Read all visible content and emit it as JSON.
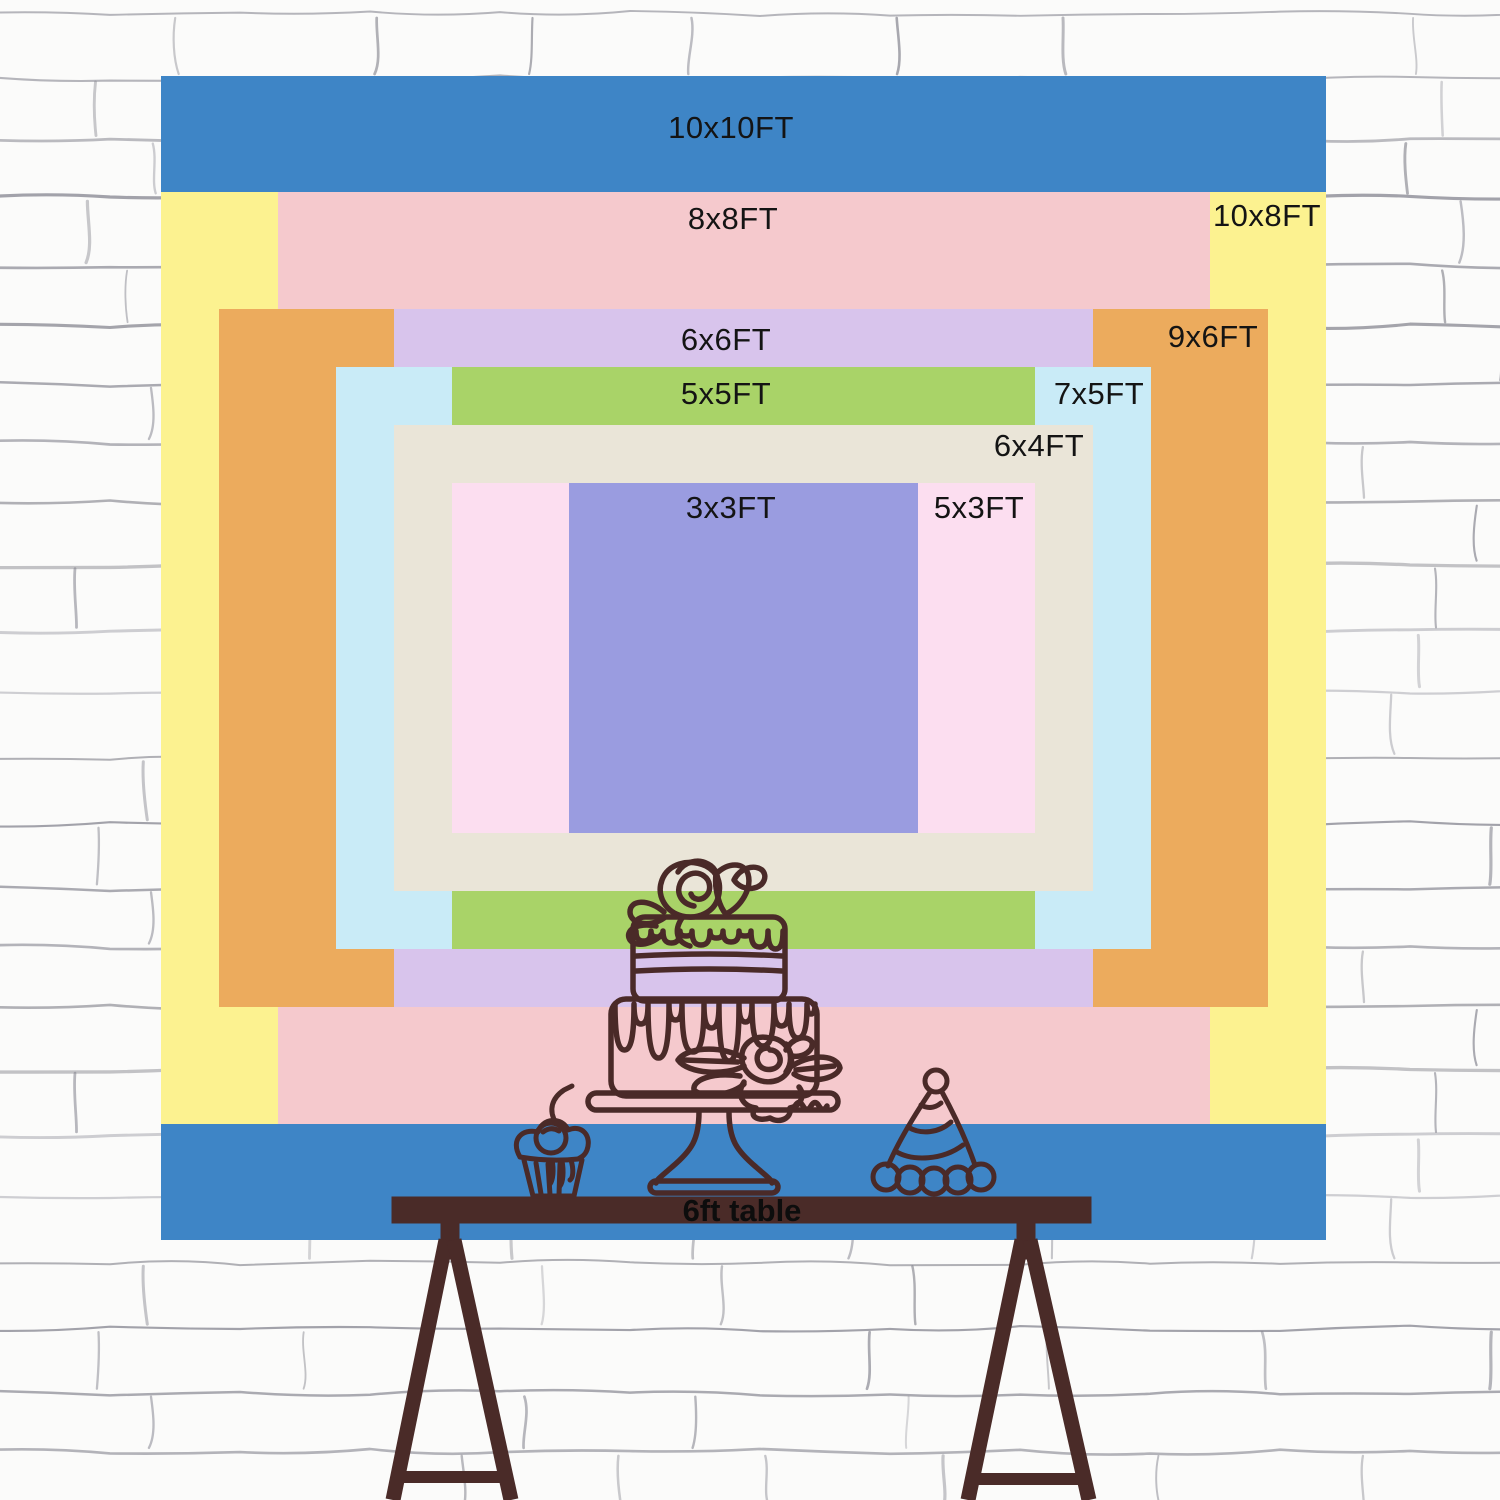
{
  "page": {
    "description_label": "Backdrop size comparison chart on brick wall"
  },
  "chart_data": {
    "type": "nested_rectangles_size_chart",
    "unit": "FT",
    "backdrop": {
      "left": 161,
      "top": 76,
      "width": 1165,
      "height": 1164,
      "feet": 10
    },
    "legend_position": "labels inside bands",
    "sizes": [
      {
        "label": "10x10FT",
        "w_ft": 10,
        "h_ft": 10,
        "color": "#3E85C6",
        "label_x": 731,
        "label_y": 128
      },
      {
        "label": "10x8FT",
        "w_ft": 10,
        "h_ft": 8,
        "color": "#FCF290",
        "label_x": 1267,
        "label_y": 216
      },
      {
        "label": "8x8FT",
        "w_ft": 8,
        "h_ft": 8,
        "color": "#F5C9CD",
        "label_x": 733,
        "label_y": 219
      },
      {
        "label": "9x6FT",
        "w_ft": 9,
        "h_ft": 6,
        "color": "#ECAB5D",
        "label_x": 1213,
        "label_y": 337
      },
      {
        "label": "6x6FT",
        "w_ft": 6,
        "h_ft": 6,
        "color": "#D8C4EC",
        "label_x": 726,
        "label_y": 340
      },
      {
        "label": "7x5FT",
        "w_ft": 7,
        "h_ft": 5,
        "color": "#C9EBF7",
        "label_x": 1099,
        "label_y": 394
      },
      {
        "label": "5x5FT",
        "w_ft": 5,
        "h_ft": 5,
        "color": "#A9D368",
        "label_x": 726,
        "label_y": 394
      },
      {
        "label": "6x4FT",
        "w_ft": 6,
        "h_ft": 4,
        "color": "#EAE5D8",
        "label_x": 1039,
        "label_y": 446
      },
      {
        "label": "5x3FT",
        "w_ft": 5,
        "h_ft": 3,
        "color": "#FCDEF0",
        "label_x": 979,
        "label_y": 508
      },
      {
        "label": "3x3FT",
        "w_ft": 3,
        "h_ft": 3,
        "color": "#9A9CE0",
        "label_x": 731,
        "label_y": 508
      }
    ]
  },
  "table": {
    "label": "6ft table",
    "color": "#4A2B28"
  },
  "decorations": [
    "cake-icon",
    "cupcake-icon",
    "party-hat-icon"
  ],
  "line_color": "#4A2A28",
  "text_color": "#141414",
  "wall": {
    "base_color": "#fbfbfa",
    "line_color": "#83838d"
  }
}
